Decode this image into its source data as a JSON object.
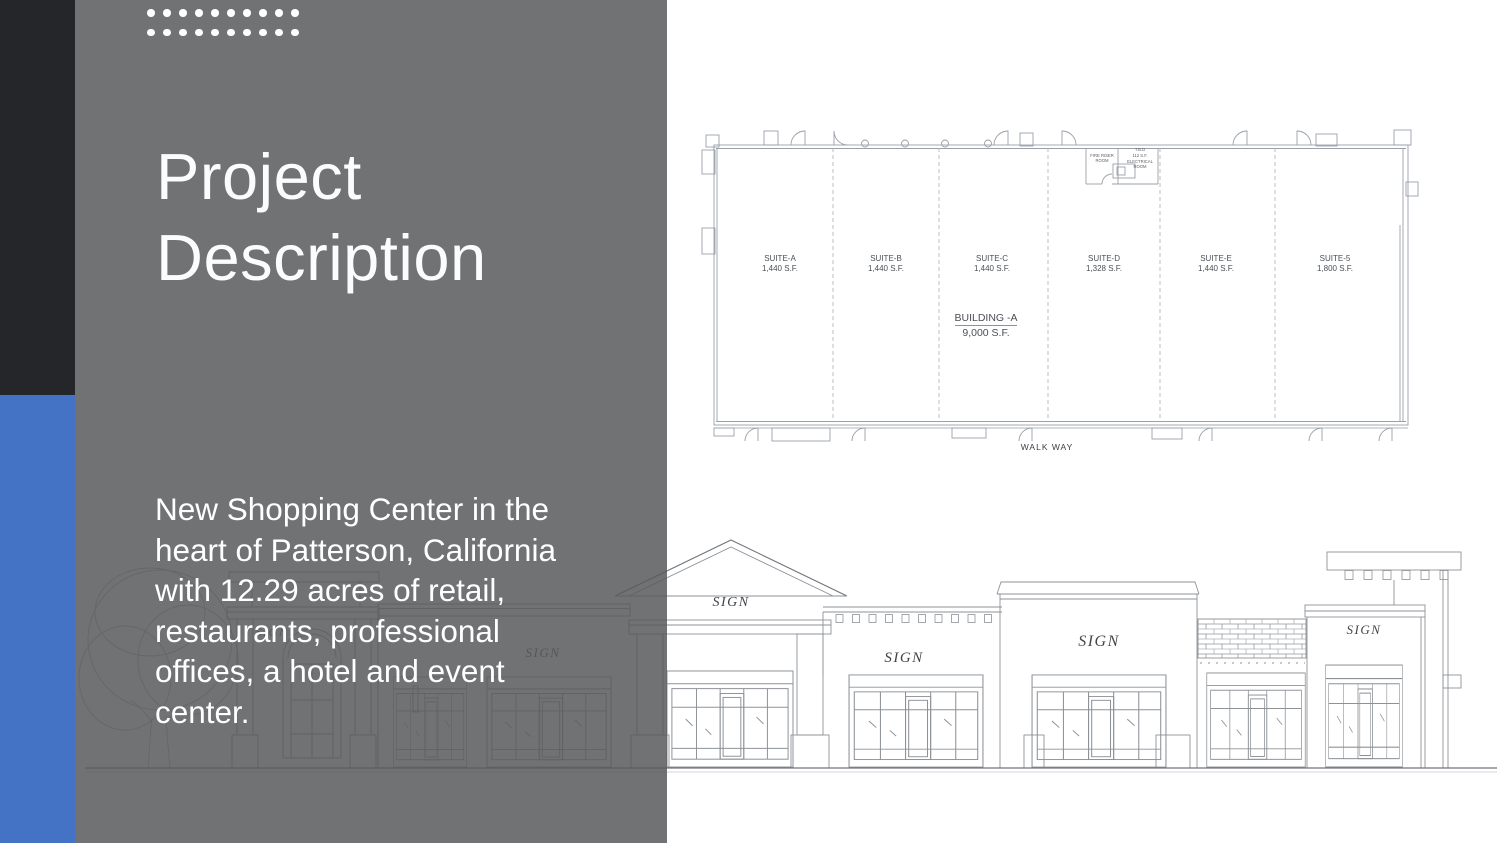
{
  "header": {
    "title_lines": [
      "Project",
      "Description"
    ]
  },
  "body": {
    "lines": [
      "New Shopping Center in the",
      "heart of Patterson, California",
      "with 12.29 acres of retail,",
      "restaurants, professional",
      "offices, a hotel and event",
      "center."
    ]
  },
  "decor": {
    "dot_rows": 2,
    "dots_per_row": 10
  },
  "colors": {
    "accent_blue": "#4472c4",
    "sidebar_dark": "#24262a",
    "overlay_gray": "rgba(88,89,91,0.85)",
    "text_white": "#ffffff"
  },
  "floor_plan": {
    "suites": [
      {
        "name": "SUITE-A",
        "area": "1,440 S.F."
      },
      {
        "name": "SUITE-B",
        "area": "1,440 S.F."
      },
      {
        "name": "SUITE-C",
        "area": "1,440 S.F."
      },
      {
        "name": "SUITE-D",
        "area": "1,328 S.F."
      },
      {
        "name": "SUITE-E",
        "area": "1,440 S.F."
      },
      {
        "name": "SUITE-5",
        "area": "1,800 S.F."
      }
    ],
    "building": {
      "name": "BUILDING -A",
      "area": "9,000 S.F."
    },
    "walkway": "WALK WAY",
    "rooms": {
      "fire_riser_l1": "FIRE RISER",
      "fire_riser_l2": "ROOM",
      "elec_l1": "T.B.D",
      "elec_l2": "112 S.F.",
      "elec_l3": "ELECTRICAL",
      "elec_l4": "ROOM"
    }
  },
  "elevation": {
    "signs": [
      "SIGN",
      "SIGN",
      "SIGN",
      "SIGN",
      "SIGN",
      "SIGN"
    ]
  }
}
